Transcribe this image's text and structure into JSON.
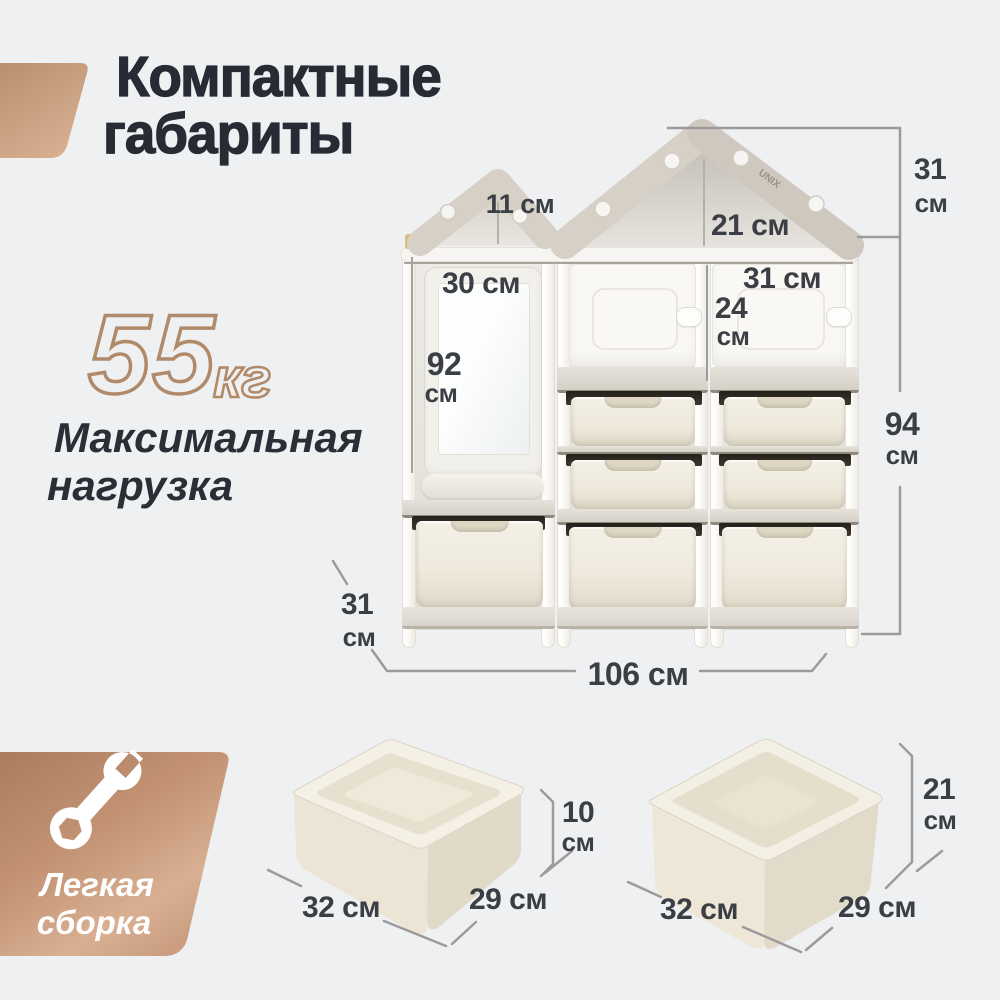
{
  "header": {
    "title_line1": "Компактные",
    "title_line2": "габариты"
  },
  "max_load": {
    "value": "55",
    "unit": "кг",
    "label_line1": "Максимальная",
    "label_line2": "нагрузка"
  },
  "assembly": {
    "line1": "Легкая",
    "line2": "сборка"
  },
  "brand": "UNIX",
  "shelf_dims": {
    "small_roof_width": "11 см",
    "large_roof_width": "21 см",
    "roof_height": {
      "num": "31",
      "unit": "см"
    },
    "board_width": "30 см",
    "door_width": "31 см",
    "door_height": {
      "num": "24",
      "unit": "см"
    },
    "board_height": {
      "num": "92",
      "unit": "см"
    },
    "body_height": {
      "num": "94",
      "unit": "см"
    },
    "depth": {
      "num": "31",
      "unit": "см"
    },
    "total_width": "106 см"
  },
  "tray_dims": {
    "width": "32 см",
    "depth": "29 см",
    "height": {
      "num": "10",
      "unit": "см"
    }
  },
  "bin_dims": {
    "width": "32 см",
    "depth": "29 см",
    "height": {
      "num": "21",
      "unit": "см"
    }
  },
  "colors": {
    "accent_bronze": "#c2957a",
    "background": "#eff0f2",
    "text_dark": "#262b34",
    "dim_text": "#3b3f45",
    "dim_line": "#9b9b9b",
    "roof": "#d6d0c7",
    "bin_ivory": "#f2eee3"
  }
}
